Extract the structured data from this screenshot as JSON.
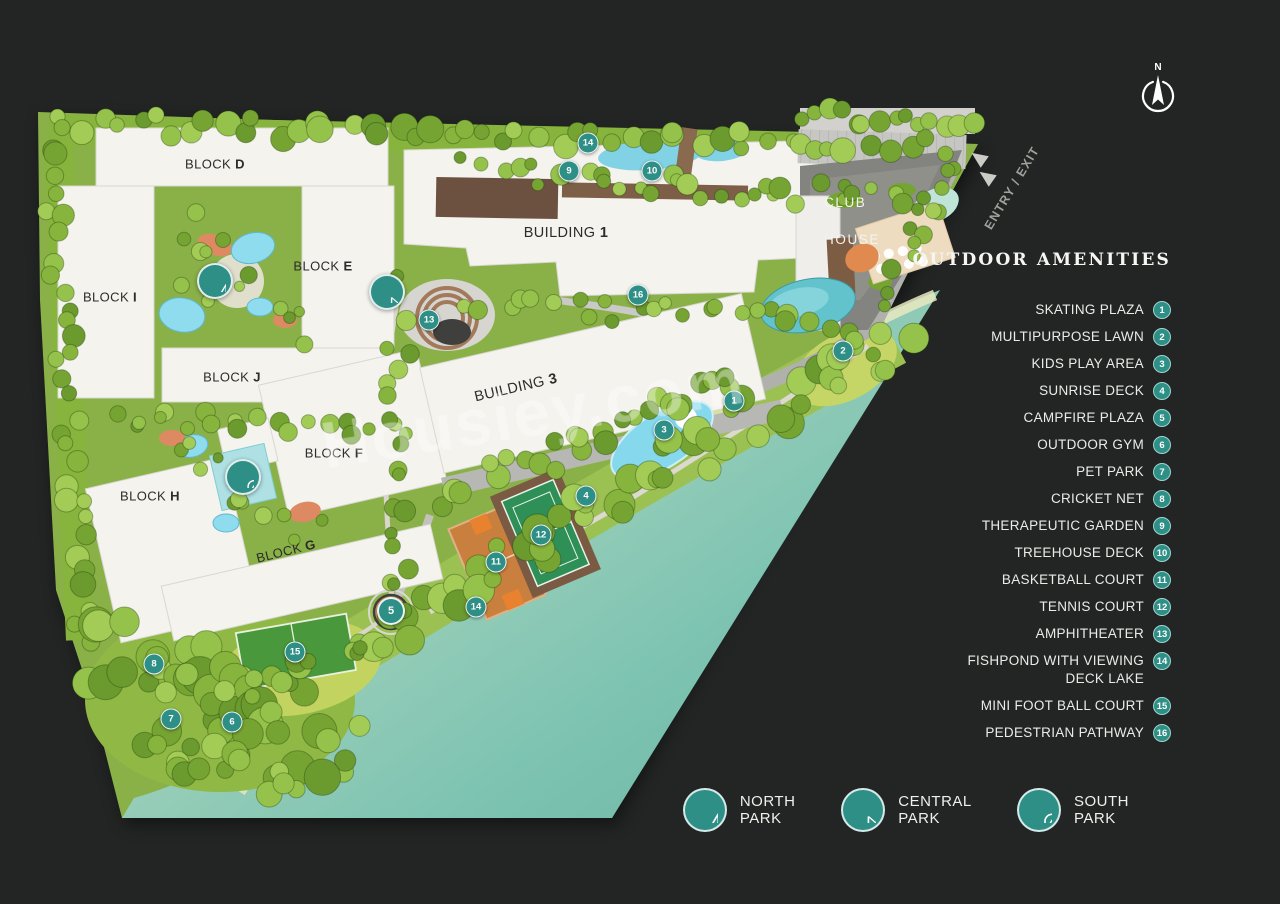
{
  "colors": {
    "accent": "#2e8f86",
    "background": "#222524",
    "water": "#76bfae",
    "badge_ring": "#9fd4cd"
  },
  "watermark": "Housiey.com",
  "compass": {
    "label": "N"
  },
  "entry": {
    "label": "ENTRY / EXIT"
  },
  "club_house": {
    "line1": "CLUB",
    "line2": "HOUSE"
  },
  "panel": {
    "title": "OUTDOOR AMENITIES",
    "amenities": [
      {
        "num": "1",
        "label": "SKATING PLAZA"
      },
      {
        "num": "2",
        "label": "MULTIPURPOSE LAWN"
      },
      {
        "num": "3",
        "label": "KIDS PLAY AREA"
      },
      {
        "num": "4",
        "label": "SUNRISE DECK"
      },
      {
        "num": "5",
        "label": "CAMPFIRE PLAZA"
      },
      {
        "num": "6",
        "label": "OUTDOOR GYM"
      },
      {
        "num": "7",
        "label": "PET PARK"
      },
      {
        "num": "8",
        "label": "CRICKET NET"
      },
      {
        "num": "9",
        "label": "THERAPEUTIC GARDEN"
      },
      {
        "num": "10",
        "label": "TREEHOUSE DECK"
      },
      {
        "num": "11",
        "label": "BASKETBALL COURT"
      },
      {
        "num": "12",
        "label": "TENNIS COURT"
      },
      {
        "num": "13",
        "label": "AMPHITHEATER"
      },
      {
        "num": "14",
        "label": "FISHPOND WITH VIEWING",
        "label2": "DECK LAKE"
      },
      {
        "num": "15",
        "label": "MINI FOOT BALL COURT"
      },
      {
        "num": "16",
        "label": "PEDESTRIAN PATHWAY"
      }
    ]
  },
  "legend": [
    {
      "id": "north",
      "label": "NORTH PARK"
    },
    {
      "id": "central",
      "label": "CENTRAL PARK"
    },
    {
      "id": "south",
      "label": "SOUTH PARK"
    }
  ],
  "map": {
    "blocks": [
      {
        "prefix": "BLOCK",
        "letter": "D",
        "x": 215,
        "y": 164,
        "rot": 0
      },
      {
        "prefix": "BLOCK",
        "letter": "E",
        "x": 323,
        "y": 266,
        "rot": 0
      },
      {
        "prefix": "BLOCK",
        "letter": "I",
        "x": 110,
        "y": 297,
        "rot": 0
      },
      {
        "prefix": "BLOCK",
        "letter": "J",
        "x": 232,
        "y": 377,
        "rot": 0
      },
      {
        "prefix": "BLOCK",
        "letter": "F",
        "x": 334,
        "y": 453,
        "rot": 0
      },
      {
        "prefix": "BLOCK",
        "letter": "H",
        "x": 150,
        "y": 496,
        "rot": 0
      },
      {
        "prefix": "BLOCK",
        "letter": "G",
        "x": 286,
        "y": 551,
        "rot": -14
      }
    ],
    "buildings": [
      {
        "prefix": "BUILDING",
        "letter": "1",
        "x": 566,
        "y": 233,
        "rot": 0
      },
      {
        "prefix": "BUILDING",
        "letter": "3",
        "x": 516,
        "y": 388,
        "rot": -13
      }
    ],
    "markers": [
      {
        "n": "1",
        "x": 734,
        "y": 401
      },
      {
        "n": "2",
        "x": 843,
        "y": 351
      },
      {
        "n": "3",
        "x": 664,
        "y": 430
      },
      {
        "n": "4",
        "x": 586,
        "y": 496
      },
      {
        "n": "5",
        "x": 391,
        "y": 611,
        "big": true
      },
      {
        "n": "6",
        "x": 232,
        "y": 722
      },
      {
        "n": "7",
        "x": 171,
        "y": 719
      },
      {
        "n": "8",
        "x": 154,
        "y": 664
      },
      {
        "n": "9",
        "x": 569,
        "y": 171
      },
      {
        "n": "10",
        "x": 652,
        "y": 171
      },
      {
        "n": "11",
        "x": 496,
        "y": 562
      },
      {
        "n": "12",
        "x": 541,
        "y": 535
      },
      {
        "n": "13",
        "x": 429,
        "y": 320
      },
      {
        "n": "14",
        "x": 588,
        "y": 143
      },
      {
        "n": "14",
        "x": 476,
        "y": 607
      },
      {
        "n": "15",
        "x": 295,
        "y": 652
      },
      {
        "n": "16",
        "x": 638,
        "y": 295
      }
    ],
    "park_icons": [
      {
        "id": "north",
        "x": 215,
        "y": 281
      },
      {
        "id": "central",
        "x": 387,
        "y": 292
      },
      {
        "id": "south",
        "x": 243,
        "y": 477
      }
    ]
  }
}
